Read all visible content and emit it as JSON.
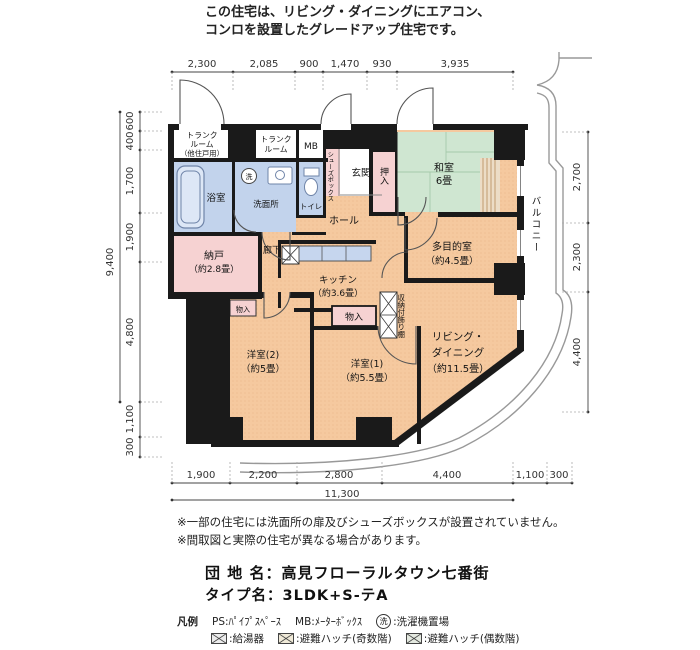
{
  "header": {
    "line1": "この住宅は、リビング・ダイニングにエアコン、",
    "line2": "コンロを設置したグレードアップ住宅です。"
  },
  "dims": {
    "top": [
      "2,300",
      "2,085",
      "900",
      "1,470",
      "930",
      "3,935"
    ],
    "left": [
      "600",
      "400",
      "1,700",
      "1,900",
      "4,800",
      "1,100",
      "300"
    ],
    "left_total": "9,400",
    "right": [
      "2,700",
      "2,300",
      "4,400"
    ],
    "bottom": [
      "1,900",
      "2,200",
      "2,800",
      "4,400",
      "1,100",
      "300"
    ],
    "bottom_total": "11,300"
  },
  "rooms": {
    "trunk_other": {
      "l1": "トランク",
      "l2": "ルーム",
      "l3": "（他住戸用）"
    },
    "trunk": {
      "l1": "トランク",
      "l2": "ルーム"
    },
    "mb": "MB",
    "shoe_box": "シューズボックス",
    "entrance": "玄関",
    "bath": "浴室",
    "washroom": "洗面所",
    "toilet": "トイレ",
    "wash_symbol": "洗",
    "closet_oshiire": "押入",
    "washitsu": {
      "l1": "和室",
      "l2": "6畳"
    },
    "hall": "ホール",
    "nando": {
      "l1": "納戸",
      "l2": "（約2.8畳）"
    },
    "corridor": "廊下",
    "kitchen": {
      "l1": "キッチン",
      "l2": "（約3.6畳）"
    },
    "multipurpose": {
      "l1": "多目的室",
      "l2": "（約4.5畳）"
    },
    "living": {
      "l1": "リビング・",
      "l2": "ダイニング",
      "l3": "（約11.5畳）"
    },
    "west_room2": {
      "l1": "洋室(2)",
      "l2": "（約5畳）"
    },
    "west_room1": {
      "l1": "洋室(1)",
      "l2": "（約5.5畳）"
    },
    "storage1": "物入",
    "storage2": "物入",
    "shelf": "収納付飾り棚",
    "balcony": "バルコニー"
  },
  "notes": {
    "line1": "※一部の住宅には洗面所の扉及びシューズボックスが設置されていません。",
    "line2": "※間取図と実際の住宅が異なる場合があります。"
  },
  "title": {
    "estate_label": "団 地 名：",
    "estate_name": "高見フローラルタウン七番街",
    "type_label": "タイプ名：",
    "type_name": "3LDK+S-テA"
  },
  "legend": {
    "heading": "凡例",
    "ps": "PS:ﾊﾟｲﾌﾟｽﾍﾟｰｽ",
    "mb": "MB:ﾒｰﾀｰﾎﾞｯｸｽ",
    "wash_symbol": "洗",
    "wash_label": ":洗濯機置場",
    "item_boiler": ":給湯器",
    "item_hatch_odd": ":避難ハッチ(奇数階)",
    "item_hatch_even": ":避難ハッチ(偶数階)"
  },
  "colors": {
    "room_main": "#f5c99f",
    "room_pink": "#f6d2d2",
    "room_wet": "#c2d3ec",
    "room_tatami": "#cfe6d1",
    "wall": "#1a1a1a"
  }
}
